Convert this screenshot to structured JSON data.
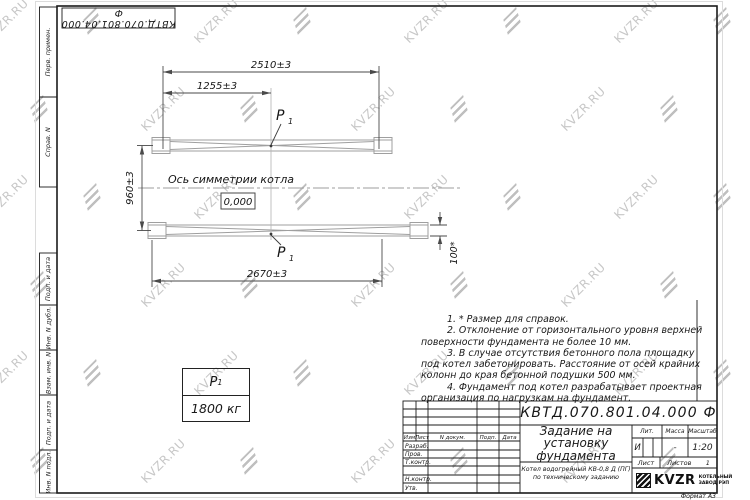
{
  "watermark": {
    "text": "KVZR.RU"
  },
  "sheet": {
    "format_note": "Формат А3"
  },
  "top_stamp": {
    "designation": "КВТД.070.801.04.000 Ф"
  },
  "margin_left": {
    "top": [
      "Перв. примен.",
      "Справ. N"
    ],
    "bottom": [
      "Подп. и дата",
      "Инв. N дубл.",
      "Взам. инв. N",
      "Подп. и дата",
      "Инв. N подл."
    ]
  },
  "drawing": {
    "dim_top": "2510±3",
    "dim_half": "1255±3",
    "dim_bottom": "2670±3",
    "dim_height": "960±3",
    "dim_width": "100*",
    "axis_label": "Ось симметрии котла",
    "elevation": "0,000",
    "load_symbol": "P",
    "load_index": "1"
  },
  "load_table": {
    "symbol": "P",
    "index": "1",
    "value": "1800 кг"
  },
  "notes": [
    "1. * Размер для справок.",
    "2. Отклонение от горизонтального уровня верхней поверхности фундамента не более 10 мм.",
    "3. В случае отсутствия бетонного пола площадку под котел забетонировать. Расстояние от осей крайних колонн до края бетонной подушки 500 мм.",
    "4. Фундамент под котел разрабатывает проектная организация по нагрузкам на фундамент."
  ],
  "title_block": {
    "designation": "КВТД.070.801.04.000 Ф",
    "doc_title": "Задание на установку фундамента",
    "product_line1": "Котел водогрейный КВ-0,8 Д (ПГ)",
    "product_line2": "по техническому заданию",
    "cols": {
      "izm": "Изм",
      "list": "Лист",
      "doc": "N докум.",
      "sign": "Подп.",
      "date": "Дата"
    },
    "rows": [
      "Разраб.",
      "Пров.",
      "Т.контр.",
      "Н.контр.",
      "Утв."
    ],
    "lit_label": "Лит.",
    "lit_value": "И",
    "mass_label": "Масса",
    "mass_value": "-",
    "scale_label": "Масштаб",
    "scale_value": "1:20",
    "sheet_label": "Лист",
    "sheets_label": "Листов",
    "sheets_value": "1",
    "logo_text": "KVZR",
    "company_line1": "КОТЕЛЬНЫЙ",
    "company_line2": "ЗАВОД РЭП"
  }
}
